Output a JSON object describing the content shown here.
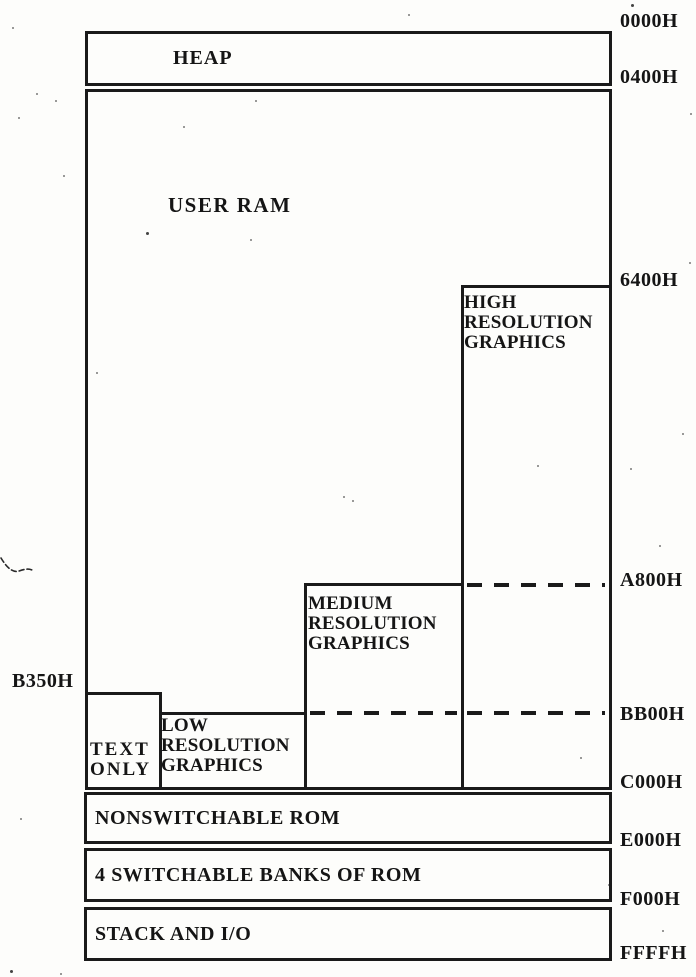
{
  "colors": {
    "ink": "#1a1a1a",
    "paper": "#fdfdfb"
  },
  "regions": {
    "heap": {
      "label": "HEAP"
    },
    "user_ram": {
      "label": "USER RAM"
    },
    "high_res": {
      "label": "HIGH\nRESOLUTION\nGRAPHICS"
    },
    "medium_res": {
      "label": "MEDIUM\nRESOLUTION\nGRAPHICS"
    },
    "low_res": {
      "label": "LOW\nRESOLUTION\nGRAPHICS"
    },
    "text_only": {
      "label": "TEXT\nONLY"
    },
    "nonswitchable_rom": {
      "label": "NONSWITCHABLE ROM"
    },
    "switchable_rom": {
      "label": "4 SWITCHABLE BANKS OF ROM"
    },
    "stack_io": {
      "label": "STACK AND I/O"
    }
  },
  "addresses": {
    "right": [
      "0000H",
      "0400H",
      "6400H",
      "A800H",
      "BB00H",
      "C000H",
      "E000H",
      "F000H",
      "FFFFH"
    ],
    "left": "B350H"
  }
}
